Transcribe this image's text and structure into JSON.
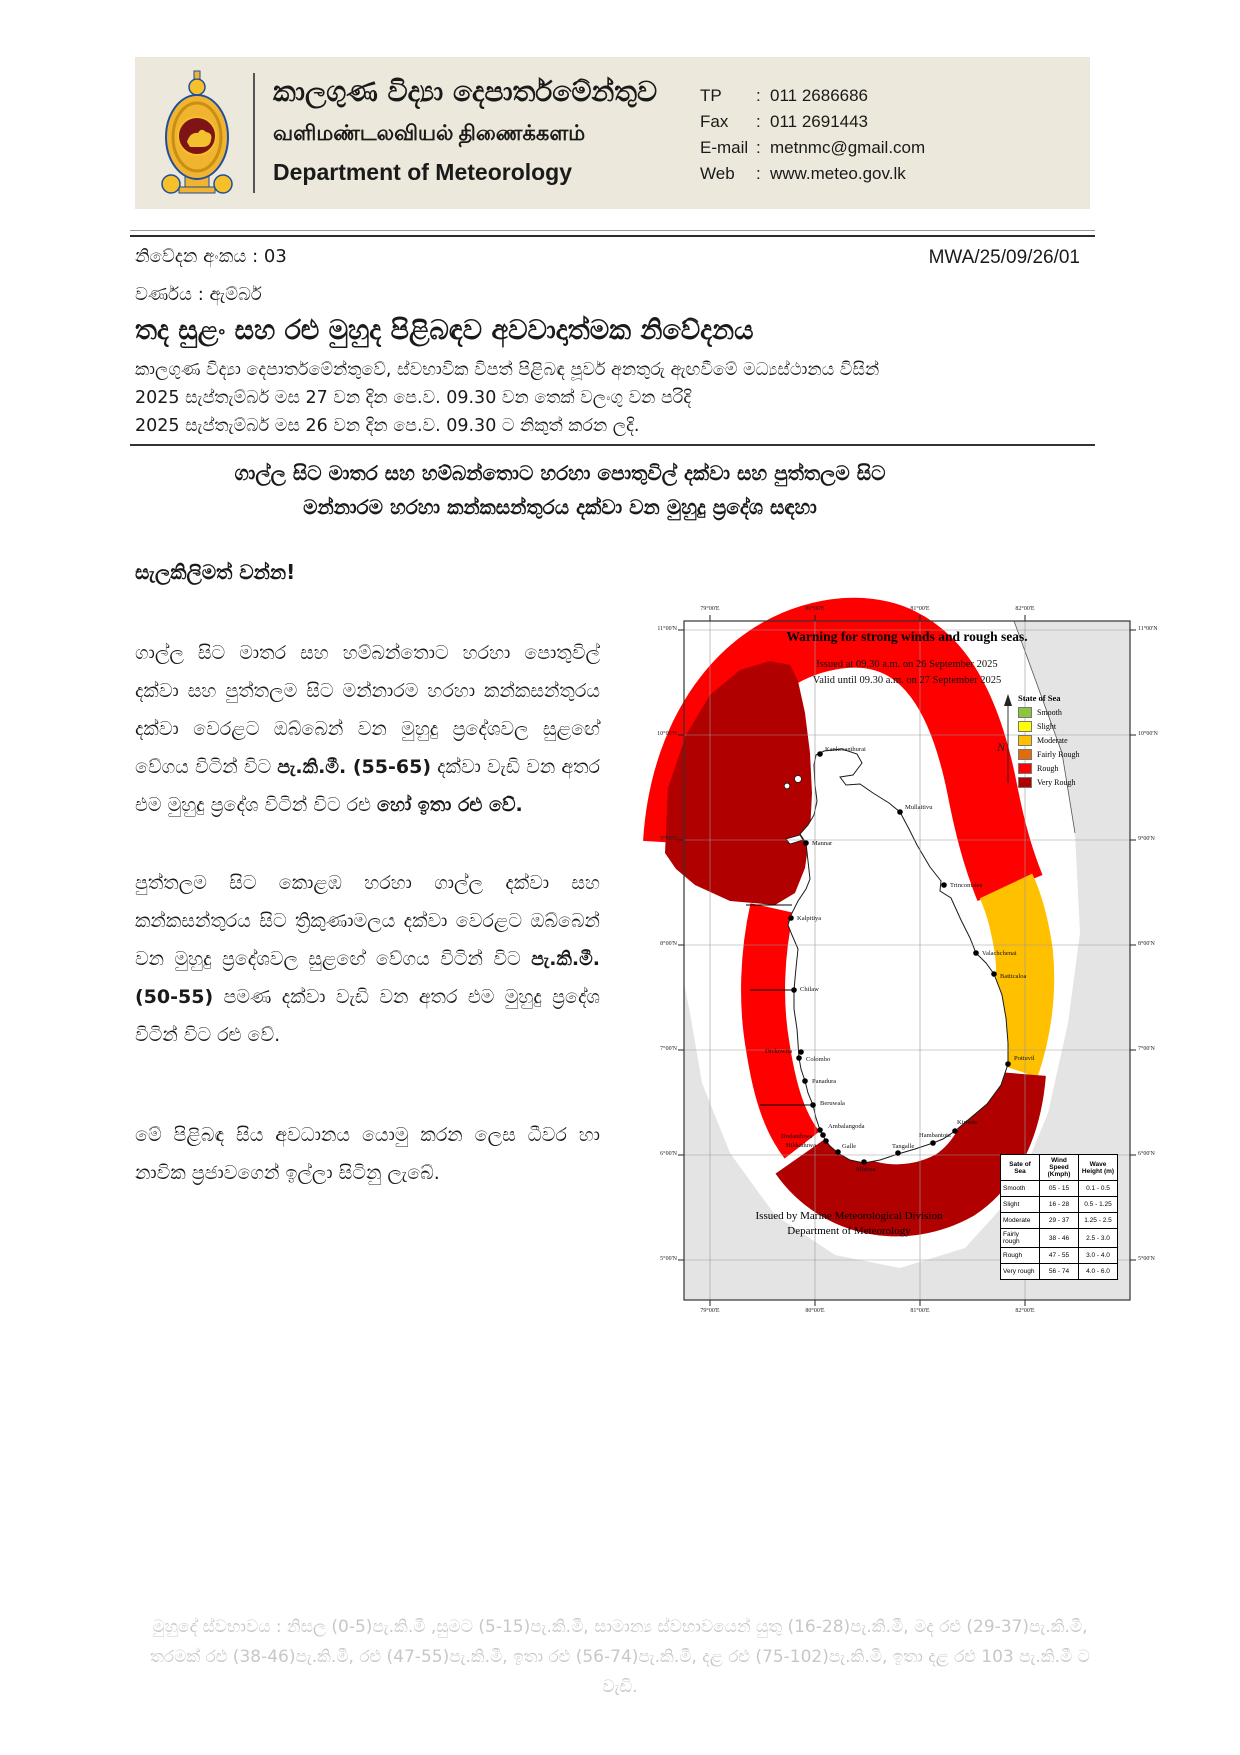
{
  "header": {
    "dept_si": "කාලගුණ විද්‍යා දෙපාර්තමේන්තුව",
    "dept_ta": "வளிமண்டலவியல் திணைக்களம்",
    "dept_en": "Department of Meteorology",
    "sep": ":",
    "contact": [
      [
        "TP",
        "011 2686686"
      ],
      [
        "Fax",
        "011 2691443"
      ],
      [
        "E-mail",
        "metnmc@gmail.com"
      ],
      [
        "Web",
        "www.meteo.gov.lk"
      ]
    ]
  },
  "meta": {
    "notice_no": "නිවේදන අංකය : 03",
    "ref_no": "MWA/25/09/26/01",
    "color_category": "වර්ණය : ඇම්බර්",
    "title": "තද සුළං සහ රළු මුහුද පිළිබඳව අවවාදාත්මක නිවේදනය",
    "issuer_line": "කාලගුණ විද්‍යා දෙපාර්තමේන්තුවේ, ස්වභාවික විපත් පිළිබඳ පූර්ව අනතුරු ඇඟවීමේ මධ්‍යස්ථානය විසින්",
    "valid_line": "2025 සැප්තැම්බර් මස 27 වන දින පෙ.ව. 09.30 වන තෙක් වලංගු වන පරිදි",
    "issued_line": "2025 සැප්තැම්බර් මස 26 වන දින පෙ.ව. 09.30 ට නිකුත් කරන ලදි."
  },
  "subject": {
    "line1": "ගාල්ල සිට මාතර සහ හම්බන්තොට හරහා පොතුවිල් දක්වා සහ පුත්තලම සිට",
    "line2": "මන්නාරම හරහා කන්කසන්තුරය දක්වා වන මුහුදු ප්‍රදේශ සඳහා"
  },
  "body": {
    "attention": "සැලකිලිමත් වන්න!",
    "paragraphs": [
      [
        {
          "t": "ගාල්ල සිට මාතර සහ හම්බන්තොට හරහා පොතුවිල් දක්වා සහ පුත්තලම සිට මන්නාරම හරහා කන්කසන්තුරය දක්වා වෙරළට ඔබ්බෙන් වන මුහුදු ප්‍රදේශවල සුළඟේ වේගය විටින් විට "
        },
        {
          "t": "පැ.කි.මී. (55-65)",
          "b": 1
        },
        {
          "t": " දක්වා වැඩි වන අතර එම මුහුදු ප්‍රදේශ විටින් විට රළු "
        },
        {
          "t": "හෝ ඉතා රළු වේ.",
          "b": 1
        }
      ],
      [
        {
          "t": "පුත්තලම සිට කොළඹ හරහා ගාල්ල දක්වා සහ කන්කසන්තුරය සිට ත්‍රිකුණාමලය දක්වා වෙරළට ඔබ්බෙන් වන මුහුදු ප්‍රදේශවල සුළඟේ වේගය විටින් විට "
        },
        {
          "t": "පැ.කි.මී. (50-55)",
          "b": 1
        },
        {
          "t": " පමණ දක්වා වැඩි වන අතර එම මුහුදු ප්‍රදේශ විටින් විට රළු වේ."
        }
      ],
      [
        {
          "t": "මේ පිළිබඳ සිය අවධානය යොමු කරන ලෙස ධීවර හා නාවික ප්‍රජාවගෙන් ඉල්ලා සිටිනු ලැබේ."
        }
      ]
    ]
  },
  "map": {
    "title": "Warning for strong winds and rough seas.",
    "issued": "Issued at 09.30 a.m. on 26 September 2025",
    "valid": "Valid until 09.30 a.m. on 27 September 2025",
    "legend_title": "State of Sea",
    "legend": [
      {
        "label": "Smooth",
        "color": "#8CC63E"
      },
      {
        "label": "Slight",
        "color": "#FFFF00"
      },
      {
        "label": "Moderate",
        "color": "#FFC000"
      },
      {
        "label": "Fairly Rough",
        "color": "#E26B0A"
      },
      {
        "label": "Rough",
        "color": "#FE0000"
      },
      {
        "label": "Very Rough",
        "color": "#B00000"
      }
    ],
    "zone_colors": {
      "rough": "#FE0000",
      "very_rough": "#B00000",
      "moderate": "#FFC000"
    },
    "cities": [
      {
        "name": "Kankesanthurai",
        "x": 210,
        "y": 201,
        "dx": 5,
        "dy": -3
      },
      {
        "name": "Mullaitivu",
        "x": 290,
        "y": 259,
        "dx": 5,
        "dy": -3
      },
      {
        "name": "Mannar",
        "x": 196,
        "y": 290,
        "dx": 6,
        "dy": 2
      },
      {
        "name": "Kalpitiya",
        "x": 181,
        "y": 365,
        "dx": 6,
        "dy": 2
      },
      {
        "name": "Trincomalee",
        "x": 334,
        "y": 332,
        "dx": 6,
        "dy": 2
      },
      {
        "name": "Valachchenai",
        "x": 366,
        "y": 400,
        "dx": 6,
        "dy": 2
      },
      {
        "name": "Batticaloa",
        "x": 384,
        "y": 421,
        "dx": 6,
        "dy": 4
      },
      {
        "name": "Chilaw",
        "x": 184,
        "y": 437,
        "dx": 6,
        "dy": 1
      },
      {
        "name": "Dickowita",
        "x": 191,
        "y": 499,
        "dx": -36,
        "dy": 1
      },
      {
        "name": "Colombo",
        "x": 189,
        "y": 505,
        "dx": 7,
        "dy": 3
      },
      {
        "name": "Panadura",
        "x": 195,
        "y": 528,
        "dx": 7,
        "dy": 2
      },
      {
        "name": "Beruwala",
        "x": 203,
        "y": 552,
        "dx": 7,
        "dy": 0
      },
      {
        "name": "Ambalangoda",
        "x": 210,
        "y": 577,
        "dx": 8,
        "dy": -2
      },
      {
        "name": "Dodanduwa",
        "x": 213,
        "y": 582,
        "dx": -42,
        "dy": 3
      },
      {
        "name": "Hikkaduwa",
        "x": 216,
        "y": 588,
        "dx": -40,
        "dy": 6
      },
      {
        "name": "Galle",
        "x": 228,
        "y": 599,
        "dx": 4,
        "dy": -4
      },
      {
        "name": "Mirissa",
        "x": 254,
        "y": 609,
        "dx": -8,
        "dy": 9
      },
      {
        "name": "Tangalle",
        "x": 288,
        "y": 600,
        "dx": -6,
        "dy": -5
      },
      {
        "name": "Hambantota",
        "x": 323,
        "y": 590,
        "dx": -14,
        "dy": -6
      },
      {
        "name": "Kirinda",
        "x": 345,
        "y": 578,
        "dx": 2,
        "dy": -7
      },
      {
        "name": "Pottuvil",
        "x": 398,
        "y": 511,
        "dx": 6,
        "dy": -4
      }
    ],
    "north_label": "N",
    "lat_labels": [
      "11°00'N",
      "10°00'N",
      "9°00'N",
      "8°00'N",
      "7°00'N",
      "6°00'N",
      "5°00'N"
    ],
    "lon_labels": [
      "79°00'E",
      "80°00'E",
      "81°00'E",
      "82°00'E"
    ],
    "credit1": "Issued by Marine Meteorological Division",
    "credit2": "Department of Meteorology",
    "table": {
      "headers": [
        "Sate of Sea",
        "Wind Speed (Kmph)",
        "Wave Height (m)"
      ],
      "rows": [
        [
          "Smooth",
          "05 - 15",
          "0.1 - 0.5"
        ],
        [
          "Slight",
          "16 - 28",
          "0.5 - 1.25"
        ],
        [
          "Moderate",
          "29 - 37",
          "1.25 - 2.5"
        ],
        [
          "Fairly rough",
          "38 - 46",
          "2.5 - 3.0"
        ],
        [
          "Rough",
          "47 - 55",
          "3.0 - 4.0"
        ],
        [
          "Very rough",
          "56 - 74",
          "4.0 - 6.0"
        ]
      ]
    }
  },
  "footer": {
    "note": "මුහුදේ ස්වභාවය : නිසල (0-5)පැ.කි.මී ,සුමට (5-15)පැ.කි.මී, සාමාන්‍ය ස්වභාවයෙන් යුතු (16-28)පැ.කි.මී, මද රළු (29-37)පැ.කි.මී, තරමක් රළු (38-46)පැ.කි.මී, රළු (47-55)පැ.කි.මී, ඉතා රළු (56-74)පැ.කි.මී, දළ රළු (75-102)පැ.කි.මී, ඉතා දළ රළු 103 පැ.කි.මී ට වැඩි."
  }
}
